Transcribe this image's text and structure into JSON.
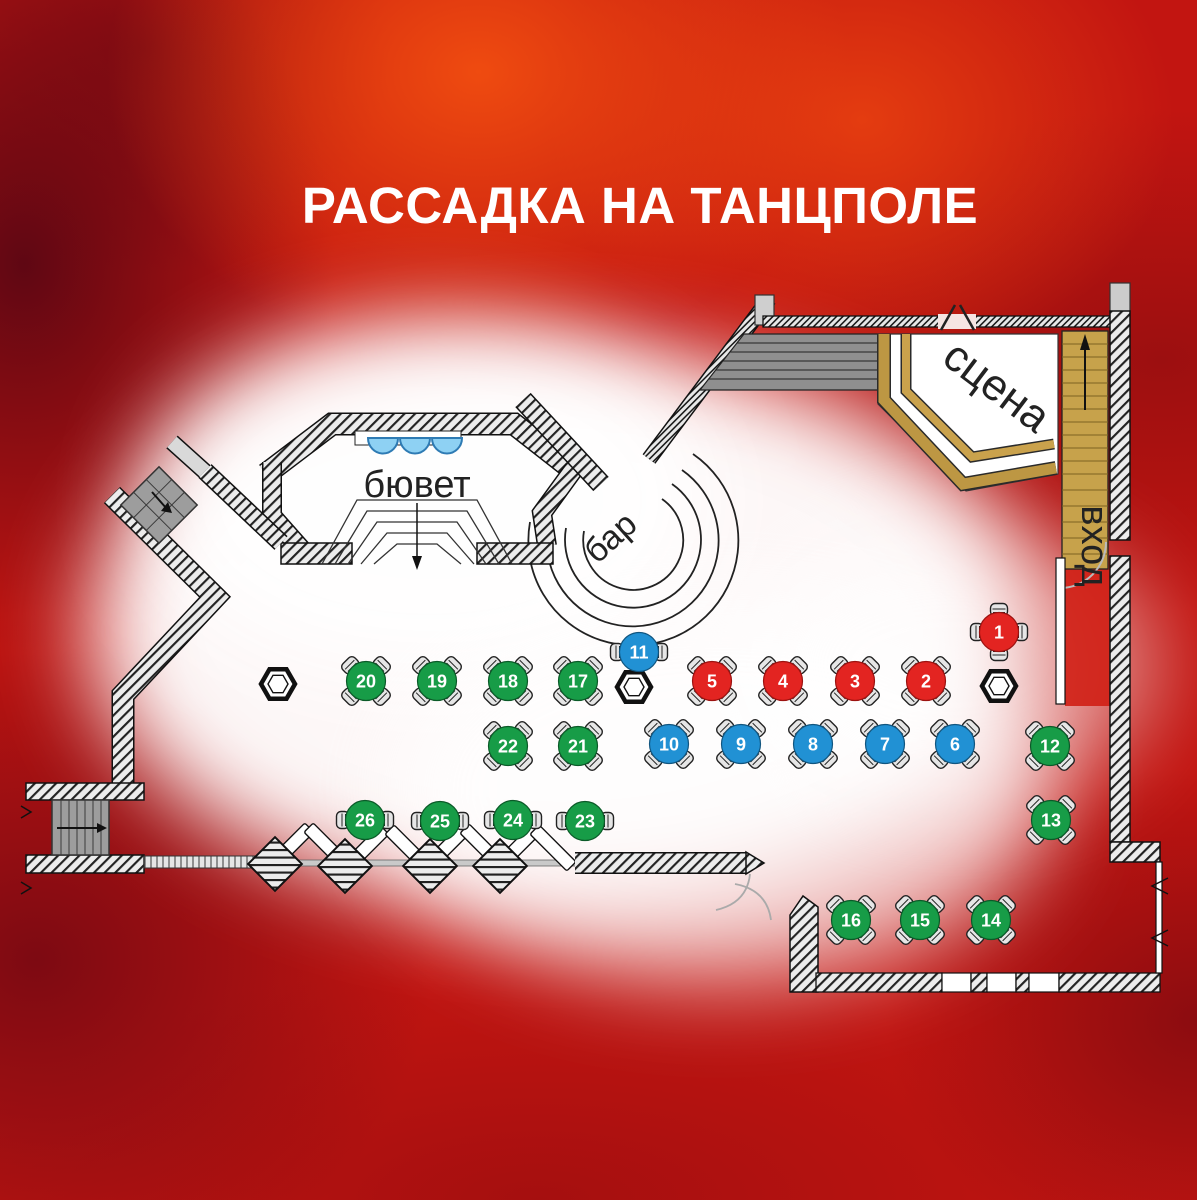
{
  "title": "РАССАДКА НА ТАНЦПОЛЕ",
  "labels": {
    "stage": "сцена",
    "bar": "бар",
    "buffet": "бювет",
    "entrance": "вход"
  },
  "colors": {
    "red": "#e32421",
    "blue": "#2191d4",
    "green": "#179c47",
    "gold": "#bd9743",
    "wall": "#ececec",
    "chair": "#e6e6e6",
    "glow": "#ffffff"
  },
  "tables": [
    {
      "number": 1,
      "color": "red",
      "x": 999,
      "y": 632,
      "chairs": "cross"
    },
    {
      "number": 2,
      "color": "red",
      "x": 926,
      "y": 681,
      "chairs": "diag"
    },
    {
      "number": 3,
      "color": "red",
      "x": 855,
      "y": 681,
      "chairs": "diag"
    },
    {
      "number": 4,
      "color": "red",
      "x": 783,
      "y": 681,
      "chairs": "diag"
    },
    {
      "number": 5,
      "color": "red",
      "x": 712,
      "y": 681,
      "chairs": "diag"
    },
    {
      "number": 6,
      "color": "blue",
      "x": 955,
      "y": 744,
      "chairs": "diag"
    },
    {
      "number": 7,
      "color": "blue",
      "x": 885,
      "y": 744,
      "chairs": "diag"
    },
    {
      "number": 8,
      "color": "blue",
      "x": 813,
      "y": 744,
      "chairs": "diag"
    },
    {
      "number": 9,
      "color": "blue",
      "x": 741,
      "y": 744,
      "chairs": "diag"
    },
    {
      "number": 10,
      "color": "blue",
      "x": 669,
      "y": 744,
      "chairs": "diag"
    },
    {
      "number": 11,
      "color": "blue",
      "x": 639,
      "y": 652,
      "chairs": "sides"
    },
    {
      "number": 12,
      "color": "green",
      "x": 1050,
      "y": 746,
      "chairs": "diag"
    },
    {
      "number": 13,
      "color": "green",
      "x": 1051,
      "y": 820,
      "chairs": "diag"
    },
    {
      "number": 14,
      "color": "green",
      "x": 991,
      "y": 920,
      "chairs": "diag"
    },
    {
      "number": 15,
      "color": "green",
      "x": 920,
      "y": 920,
      "chairs": "diag"
    },
    {
      "number": 16,
      "color": "green",
      "x": 851,
      "y": 920,
      "chairs": "diag"
    },
    {
      "number": 17,
      "color": "green",
      "x": 578,
      "y": 681,
      "chairs": "diag"
    },
    {
      "number": 18,
      "color": "green",
      "x": 508,
      "y": 681,
      "chairs": "diag"
    },
    {
      "number": 19,
      "color": "green",
      "x": 437,
      "y": 681,
      "chairs": "diag"
    },
    {
      "number": 20,
      "color": "green",
      "x": 366,
      "y": 681,
      "chairs": "diag"
    },
    {
      "number": 21,
      "color": "green",
      "x": 578,
      "y": 746,
      "chairs": "diag"
    },
    {
      "number": 22,
      "color": "green",
      "x": 508,
      "y": 746,
      "chairs": "diag"
    },
    {
      "number": 23,
      "color": "green",
      "x": 585,
      "y": 821,
      "chairs": "sides"
    },
    {
      "number": 24,
      "color": "green",
      "x": 513,
      "y": 820,
      "chairs": "sides"
    },
    {
      "number": 25,
      "color": "green",
      "x": 440,
      "y": 821,
      "chairs": "sides"
    },
    {
      "number": 26,
      "color": "green",
      "x": 365,
      "y": 820,
      "chairs": "sides"
    }
  ],
  "pillars": [
    {
      "x": 278,
      "y": 684
    },
    {
      "x": 634,
      "y": 687
    },
    {
      "x": 999,
      "y": 686
    }
  ]
}
